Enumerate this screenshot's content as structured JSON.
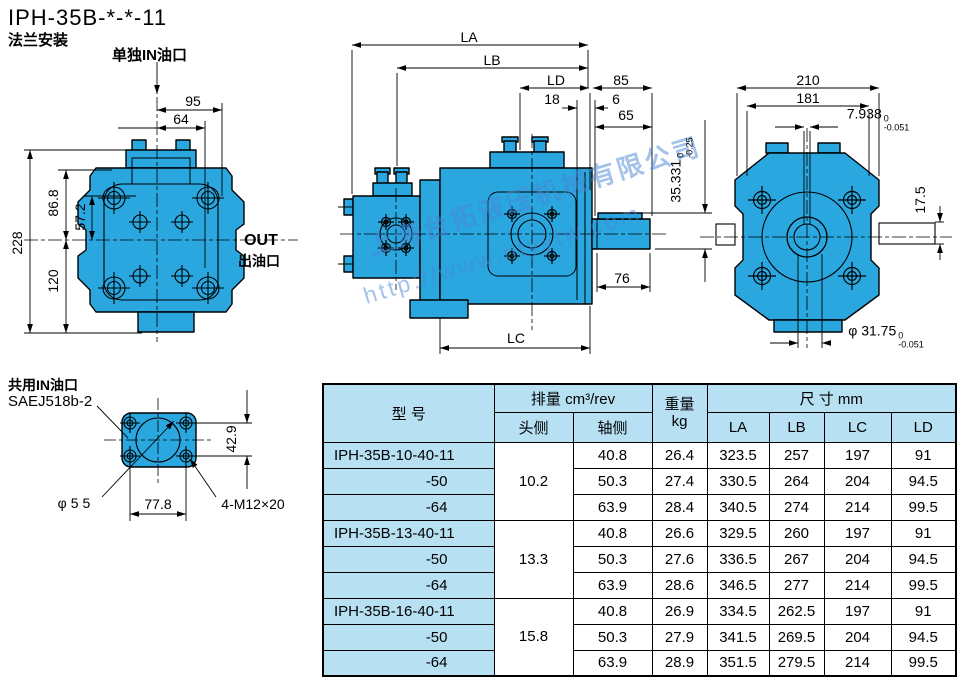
{
  "colors": {
    "pump_fill": "#2aa7df",
    "table_header_bg": "#b7e0f3",
    "line": "#000000",
    "watermark": "#4886d6"
  },
  "header": {
    "title": "IPH-35B-*-*-11",
    "subtitle": "法兰安装"
  },
  "front_view": {
    "in_port_label": "单独IN油口",
    "out_label": "OUT",
    "out_sublabel": "出油口",
    "dim_95": "95",
    "dim_64": "64",
    "dim_228": "228",
    "dim_86_8": "86.8",
    "dim_57_2": "57.2",
    "dim_120": "120"
  },
  "side_view": {
    "dim_la": "LA",
    "dim_lb": "LB",
    "dim_ld": "LD",
    "dim_85": "85",
    "dim_18": "18",
    "dim_6": "6",
    "dim_65": "65",
    "dim_76": "76",
    "dim_lc": "LC",
    "key_height": {
      "value": "35.331",
      "tol_top": "0",
      "tol_bottom": "-0.25"
    },
    "watermark_line1": "上海台拓液压机械有限公司",
    "watermark_line2": "http://www.htyytw.com"
  },
  "rear_view": {
    "dim_210": "210",
    "dim_181": "181",
    "dim_17_5": "17.5",
    "key_width": {
      "value": "7.938",
      "tol_top": "0",
      "tol_bottom": "-0.051"
    },
    "shaft_dia": {
      "value": "φ 31.75",
      "tol_top": "0",
      "tol_bottom": "-0.051"
    }
  },
  "flange_view": {
    "label_line1": "共用IN油口",
    "label_line2": "SAEJ518b-2",
    "dim_dia": "φ55",
    "dim_77_8": "77.8",
    "dim_42_9": "42.9",
    "bolt_spec": "4-M12×20"
  },
  "table": {
    "header": {
      "model": "型 号",
      "displacement": "排量 cm³/rev",
      "head_side": "头侧",
      "shaft_side": "轴侧",
      "weight": "重量",
      "weight_unit": "kg",
      "dimensions": "尺 寸  mm",
      "la": "LA",
      "lb": "LB",
      "lc": "LC",
      "ld": "LD"
    },
    "rows": [
      {
        "model": "IPH-35B-10-40-11",
        "head": "10.2",
        "shaft": "40.8",
        "weight": "26.4",
        "la": "323.5",
        "lb": "257",
        "lc": "197",
        "ld": "91"
      },
      {
        "model": "-50",
        "shaft": "50.3",
        "weight": "27.4",
        "la": "330.5",
        "lb": "264",
        "lc": "204",
        "ld": "94.5"
      },
      {
        "model": "-64",
        "shaft": "63.9",
        "weight": "28.4",
        "la": "340.5",
        "lb": "274",
        "lc": "214",
        "ld": "99.5"
      },
      {
        "model": "IPH-35B-13-40-11",
        "head": "13.3",
        "shaft": "40.8",
        "weight": "26.6",
        "la": "329.5",
        "lb": "260",
        "lc": "197",
        "ld": "91"
      },
      {
        "model": "-50",
        "shaft": "50.3",
        "weight": "27.6",
        "la": "336.5",
        "lb": "267",
        "lc": "204",
        "ld": "94.5"
      },
      {
        "model": "-64",
        "shaft": "63.9",
        "weight": "28.6",
        "la": "346.5",
        "lb": "277",
        "lc": "214",
        "ld": "99.5"
      },
      {
        "model": "IPH-35B-16-40-11",
        "head": "15.8",
        "shaft": "40.8",
        "weight": "26.9",
        "la": "334.5",
        "lb": "262.5",
        "lc": "197",
        "ld": "91"
      },
      {
        "model": "-50",
        "shaft": "50.3",
        "weight": "27.9",
        "la": "341.5",
        "lb": "269.5",
        "lc": "204",
        "ld": "94.5"
      },
      {
        "model": "-64",
        "shaft": "63.9",
        "weight": "28.9",
        "la": "351.5",
        "lb": "279.5",
        "lc": "214",
        "ld": "99.5"
      }
    ]
  }
}
